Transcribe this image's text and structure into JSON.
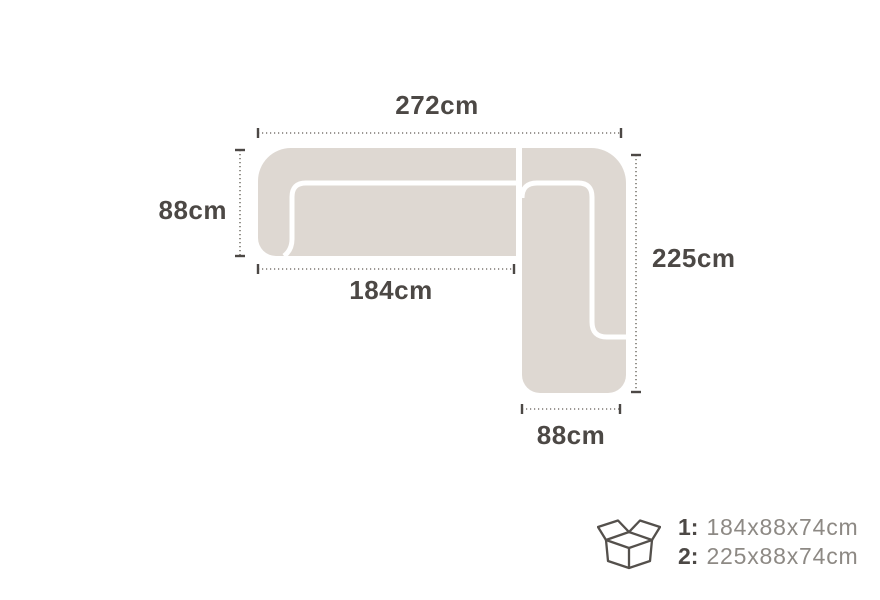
{
  "diagram": {
    "type": "corner-sofa-top-view-dimensions",
    "colors": {
      "background": "#ffffff",
      "sofa_fill": "#ded8d2",
      "seam": "#ffffff",
      "dimension_text": "#4c4845",
      "dotted_line": "#7b7770",
      "legend_value_text": "#8d8984"
    },
    "dimensions": {
      "total_width": "272cm",
      "left_depth": "88cm",
      "right_length": "225cm",
      "section1_length": "184cm",
      "bottom_depth": "88cm"
    }
  },
  "legend": {
    "icon": "open-cardboard-box-icon",
    "items": [
      {
        "index": "1:",
        "size": "184x88x74cm"
      },
      {
        "index": "2:",
        "size": "225x88x74cm"
      }
    ]
  }
}
